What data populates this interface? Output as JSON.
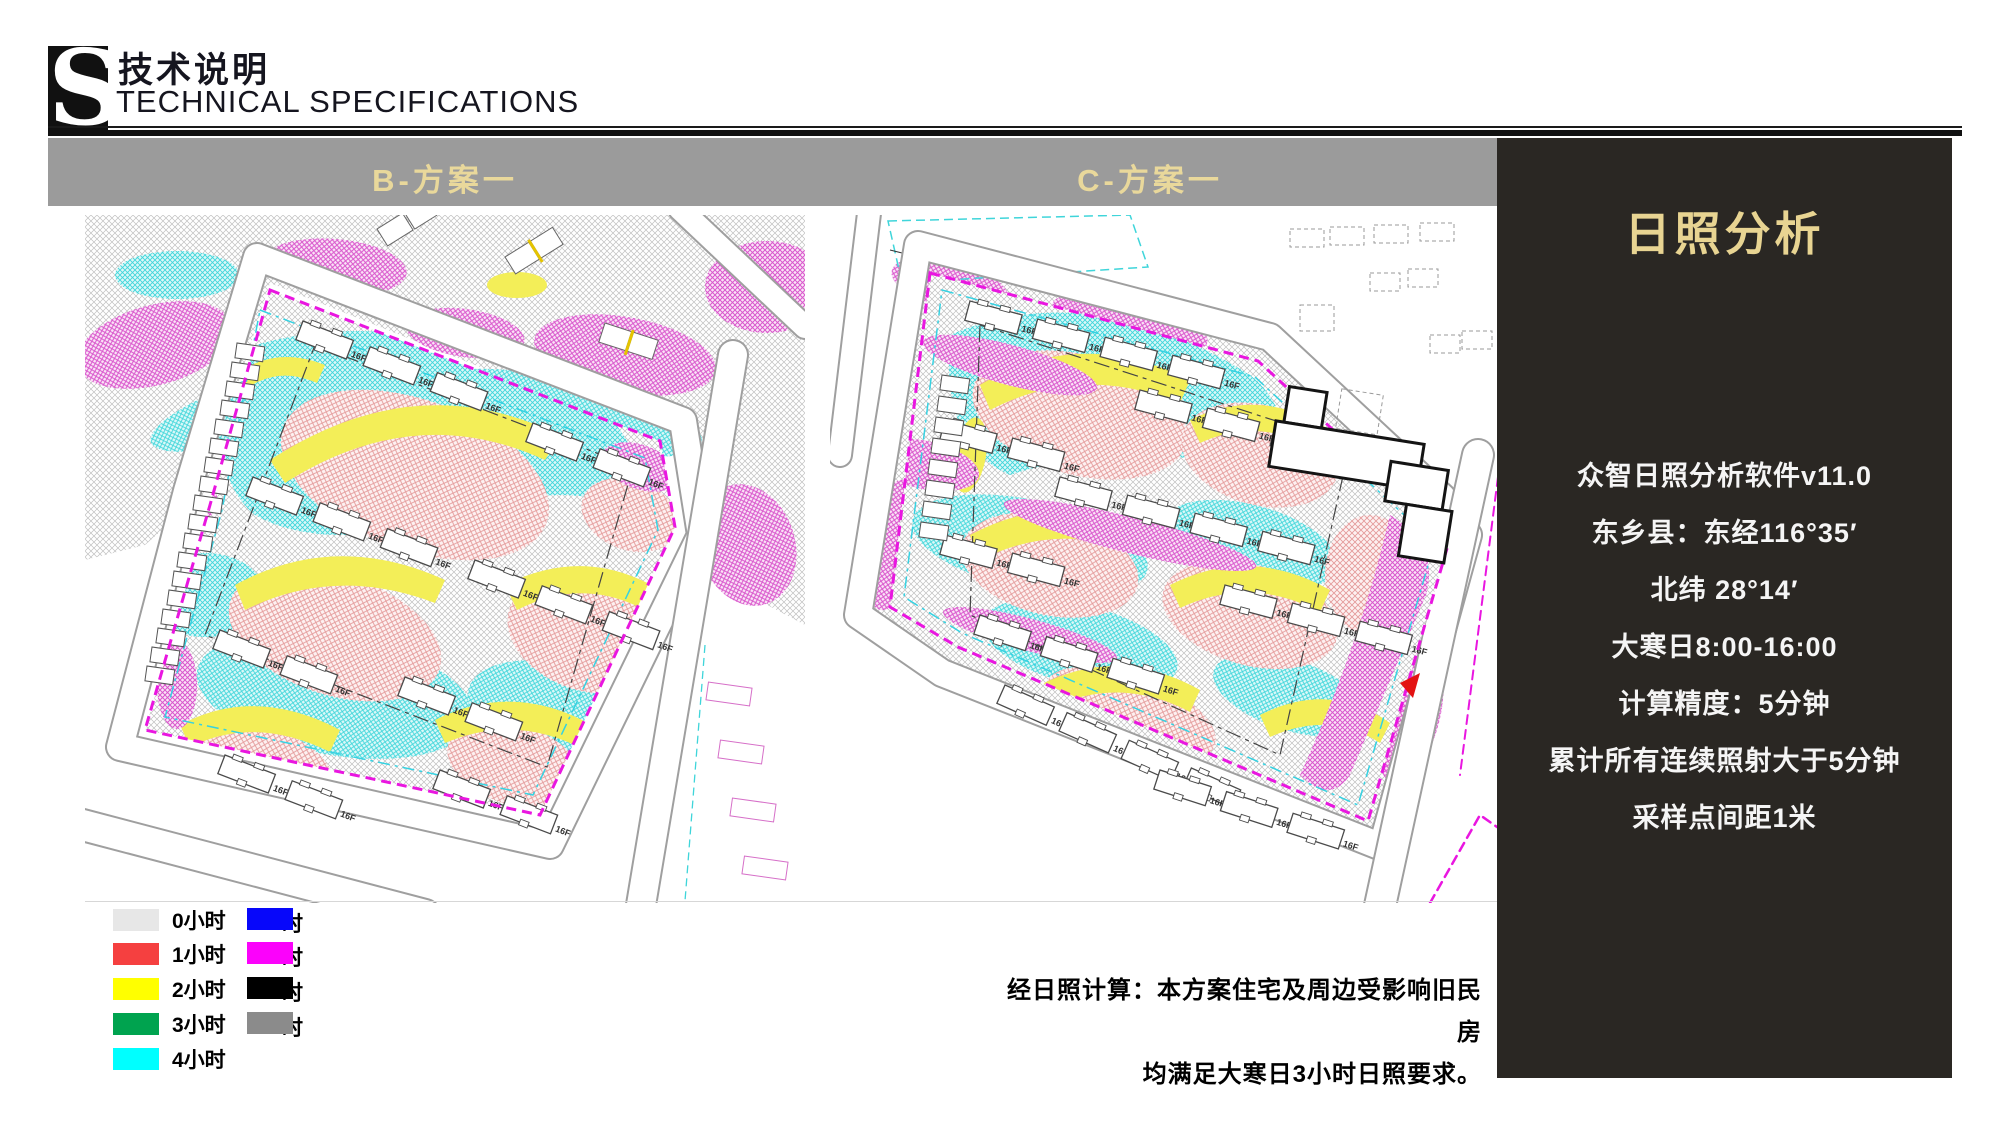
{
  "header": {
    "logo_letter": "S",
    "title_zh": "技术说明",
    "title_en": "TECHNICAL SPECIFICATIONS"
  },
  "scheme_bar": {
    "bg_color": "#9b9b9b",
    "text_color": "#e9d89b",
    "left_label": "B-方案一",
    "right_label": "C-方案一"
  },
  "maps": {
    "left_name": "sunlight-analysis-map-scheme-b",
    "right_name": "sunlight-analysis-map-scheme-c"
  },
  "legend": {
    "col1": [
      {
        "label": "0小时",
        "color": "#e7e7e7"
      },
      {
        "label": "1小时",
        "color": "#f54040"
      },
      {
        "label": "2小时",
        "color": "#ffff00"
      },
      {
        "label": "3小时",
        "color": "#00a34f"
      },
      {
        "label": "4小时",
        "color": "#00ffff"
      }
    ],
    "col2": [
      {
        "clipped_label": "时",
        "color": "#0707fa"
      },
      {
        "clipped_label": "时",
        "color": "#fb02fb"
      },
      {
        "clipped_label": "时",
        "color": "#000000"
      },
      {
        "clipped_label": "时",
        "color": "#8b8b8b"
      }
    ]
  },
  "side_panel": {
    "bg_color": "#2a2723",
    "title": "日照分析",
    "title_color": "#e8d492",
    "lines": [
      "众智日照分析软件v11.0",
      "东乡县：东经116°35′",
      "北纬 28°14′",
      "大寒日8:00-16:00",
      "计算精度：5分钟",
      "累计所有连续照射大于5分钟",
      "采样点间距1米"
    ]
  },
  "note": {
    "line1": "经日照计算：本方案住宅及周边受影响旧民房",
    "line2": "均满足大寒日3小时日照要求。"
  }
}
